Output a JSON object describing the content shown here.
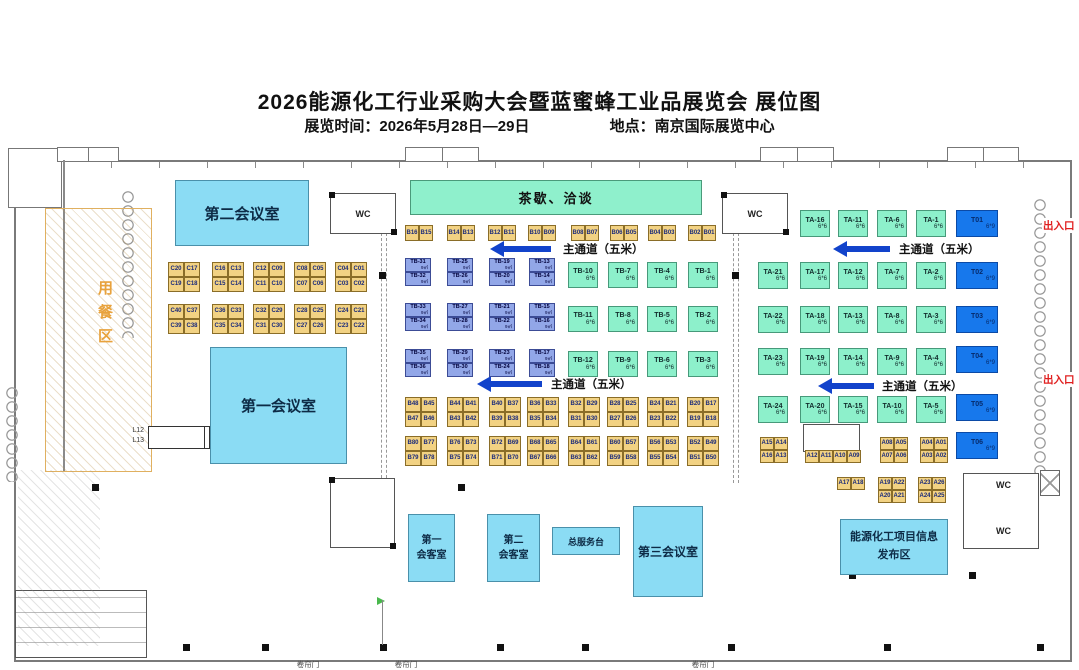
{
  "header": {
    "title": "2026能源化工行业采购大会暨蓝蜜蜂工业品展览会 展位图",
    "time": "展览时间：2026年5月28日—29日",
    "location": "地点：南京国际展览中心"
  },
  "labels": {
    "aisle": "主通道（五米）",
    "exit": "出入口",
    "dining": "用餐区",
    "shutter": "卷帘门",
    "wc": "WC"
  },
  "areas": {
    "tea": "茶歇、洽谈",
    "meeting1": "第一会议室",
    "meeting2": "第二会议室",
    "meeting3": "第三会议室",
    "reception1": {
      "line1": "第一",
      "line2": "会客室"
    },
    "reception2": {
      "line1": "第二",
      "line2": "会客室"
    },
    "service_desk": "总服务台",
    "info_zone": {
      "line1": "能源化工项目信息",
      "line2": "发布区"
    },
    "l_booths": {
      "top": "L12",
      "bottom": "L13"
    }
  },
  "booth_groups": [
    {
      "t": "y",
      "x": 168,
      "y": 262,
      "w": 16,
      "h": 15,
      "r": [
        [
          "C20",
          "C17"
        ],
        [
          "C19",
          "C18"
        ]
      ]
    },
    {
      "t": "y",
      "x": 212,
      "y": 262,
      "w": 16,
      "h": 15,
      "r": [
        [
          "C16",
          "C13"
        ],
        [
          "C15",
          "C14"
        ]
      ]
    },
    {
      "t": "y",
      "x": 253,
      "y": 262,
      "w": 16,
      "h": 15,
      "r": [
        [
          "C12",
          "C09"
        ],
        [
          "C11",
          "C10"
        ]
      ]
    },
    {
      "t": "y",
      "x": 294,
      "y": 262,
      "w": 16,
      "h": 15,
      "r": [
        [
          "C08",
          "C05"
        ],
        [
          "C07",
          "C06"
        ]
      ]
    },
    {
      "t": "y",
      "x": 335,
      "y": 262,
      "w": 16,
      "h": 15,
      "r": [
        [
          "C04",
          "C01"
        ],
        [
          "C03",
          "C02"
        ]
      ]
    },
    {
      "t": "y",
      "x": 168,
      "y": 304,
      "w": 16,
      "h": 15,
      "r": [
        [
          "C40",
          "C37"
        ],
        [
          "C39",
          "C38"
        ]
      ]
    },
    {
      "t": "y",
      "x": 212,
      "y": 304,
      "w": 16,
      "h": 15,
      "r": [
        [
          "C36",
          "C33"
        ],
        [
          "C35",
          "C34"
        ]
      ]
    },
    {
      "t": "y",
      "x": 253,
      "y": 304,
      "w": 16,
      "h": 15,
      "r": [
        [
          "C32",
          "C29"
        ],
        [
          "C31",
          "C30"
        ]
      ]
    },
    {
      "t": "y",
      "x": 294,
      "y": 304,
      "w": 16,
      "h": 15,
      "r": [
        [
          "C28",
          "C25"
        ],
        [
          "C27",
          "C26"
        ]
      ]
    },
    {
      "t": "y",
      "x": 335,
      "y": 304,
      "w": 16,
      "h": 15,
      "r": [
        [
          "C24",
          "C21"
        ],
        [
          "C23",
          "C22"
        ]
      ]
    },
    {
      "t": "y",
      "x": 405,
      "y": 225,
      "w": 14,
      "h": 16,
      "r": [
        [
          "B16",
          "B15"
        ]
      ]
    },
    {
      "t": "y",
      "x": 447,
      "y": 225,
      "w": 14,
      "h": 16,
      "r": [
        [
          "B14",
          "B13"
        ]
      ]
    },
    {
      "t": "y",
      "x": 488,
      "y": 225,
      "w": 14,
      "h": 16,
      "r": [
        [
          "B12",
          "B11"
        ]
      ]
    },
    {
      "t": "y",
      "x": 528,
      "y": 225,
      "w": 14,
      "h": 16,
      "r": [
        [
          "B10",
          "B09"
        ]
      ]
    },
    {
      "t": "y",
      "x": 571,
      "y": 225,
      "w": 14,
      "h": 16,
      "r": [
        [
          "B08",
          "B07"
        ]
      ]
    },
    {
      "t": "y",
      "x": 610,
      "y": 225,
      "w": 14,
      "h": 16,
      "r": [
        [
          "B06",
          "B05"
        ]
      ]
    },
    {
      "t": "y",
      "x": 648,
      "y": 225,
      "w": 14,
      "h": 16,
      "r": [
        [
          "B04",
          "B03"
        ]
      ]
    },
    {
      "t": "y",
      "x": 688,
      "y": 225,
      "w": 14,
      "h": 16,
      "r": [
        [
          "B02",
          "B01"
        ]
      ]
    },
    {
      "t": "b",
      "x": 405,
      "y": 258,
      "w": 26,
      "h": 14,
      "s": "9㎡",
      "r": [
        [
          "TB-31"
        ],
        [
          "TB-32"
        ]
      ]
    },
    {
      "t": "b",
      "x": 447,
      "y": 258,
      "w": 26,
      "h": 14,
      "s": "9㎡",
      "r": [
        [
          "TB-25"
        ],
        [
          "TB-26"
        ]
      ]
    },
    {
      "t": "b",
      "x": 489,
      "y": 258,
      "w": 26,
      "h": 14,
      "s": "9㎡",
      "r": [
        [
          "TB-19"
        ],
        [
          "TB-20"
        ]
      ]
    },
    {
      "t": "b",
      "x": 529,
      "y": 258,
      "w": 26,
      "h": 14,
      "s": "9㎡",
      "r": [
        [
          "TB-13"
        ],
        [
          "TB-14"
        ]
      ]
    },
    {
      "t": "b",
      "x": 405,
      "y": 303,
      "w": 26,
      "h": 14,
      "s": "9㎡",
      "r": [
        [
          "TB-33"
        ],
        [
          "TB-34"
        ]
      ]
    },
    {
      "t": "b",
      "x": 447,
      "y": 303,
      "w": 26,
      "h": 14,
      "s": "9㎡",
      "r": [
        [
          "TB-27"
        ],
        [
          "TB-28"
        ]
      ]
    },
    {
      "t": "b",
      "x": 489,
      "y": 303,
      "w": 26,
      "h": 14,
      "s": "9㎡",
      "r": [
        [
          "TB-21"
        ],
        [
          "TB-22"
        ]
      ]
    },
    {
      "t": "b",
      "x": 529,
      "y": 303,
      "w": 26,
      "h": 14,
      "s": "9㎡",
      "r": [
        [
          "TB-15"
        ],
        [
          "TB-16"
        ]
      ]
    },
    {
      "t": "b",
      "x": 405,
      "y": 349,
      "w": 26,
      "h": 14,
      "s": "9㎡",
      "r": [
        [
          "TB-35"
        ],
        [
          "TB-36"
        ]
      ]
    },
    {
      "t": "b",
      "x": 447,
      "y": 349,
      "w": 26,
      "h": 14,
      "s": "9㎡",
      "r": [
        [
          "TB-29"
        ],
        [
          "TB-30"
        ]
      ]
    },
    {
      "t": "b",
      "x": 489,
      "y": 349,
      "w": 26,
      "h": 14,
      "s": "9㎡",
      "r": [
        [
          "TB-23"
        ],
        [
          "TB-24"
        ]
      ]
    },
    {
      "t": "b",
      "x": 529,
      "y": 349,
      "w": 26,
      "h": 14,
      "s": "9㎡",
      "r": [
        [
          "TB-17"
        ],
        [
          "TB-18"
        ]
      ]
    },
    {
      "t": "g",
      "x": 568,
      "y": 262,
      "w": 30,
      "h": 26,
      "s": "6*6",
      "r": [
        [
          "TB-10"
        ]
      ]
    },
    {
      "t": "g",
      "x": 568,
      "y": 306,
      "w": 30,
      "h": 26,
      "s": "6*6",
      "r": [
        [
          "TB-11"
        ]
      ]
    },
    {
      "t": "g",
      "x": 568,
      "y": 351,
      "w": 30,
      "h": 26,
      "s": "6*6",
      "r": [
        [
          "TB-12"
        ]
      ]
    },
    {
      "t": "g",
      "x": 608,
      "y": 262,
      "w": 30,
      "h": 26,
      "s": "6*6",
      "r": [
        [
          "TB-7"
        ]
      ]
    },
    {
      "t": "g",
      "x": 608,
      "y": 306,
      "w": 30,
      "h": 26,
      "s": "6*6",
      "r": [
        [
          "TB-8"
        ]
      ]
    },
    {
      "t": "g",
      "x": 608,
      "y": 351,
      "w": 30,
      "h": 26,
      "s": "6*6",
      "r": [
        [
          "TB-9"
        ]
      ]
    },
    {
      "t": "g",
      "x": 647,
      "y": 262,
      "w": 30,
      "h": 26,
      "s": "6*6",
      "r": [
        [
          "TB-4"
        ]
      ]
    },
    {
      "t": "g",
      "x": 647,
      "y": 306,
      "w": 30,
      "h": 26,
      "s": "6*6",
      "r": [
        [
          "TB-5"
        ]
      ]
    },
    {
      "t": "g",
      "x": 647,
      "y": 351,
      "w": 30,
      "h": 26,
      "s": "6*6",
      "r": [
        [
          "TB-6"
        ]
      ]
    },
    {
      "t": "g",
      "x": 688,
      "y": 262,
      "w": 30,
      "h": 26,
      "s": "6*6",
      "r": [
        [
          "TB-1"
        ]
      ]
    },
    {
      "t": "g",
      "x": 688,
      "y": 306,
      "w": 30,
      "h": 26,
      "s": "6*6",
      "r": [
        [
          "TB-2"
        ]
      ]
    },
    {
      "t": "g",
      "x": 688,
      "y": 351,
      "w": 30,
      "h": 26,
      "s": "6*6",
      "r": [
        [
          "TB-3"
        ]
      ]
    },
    {
      "t": "g",
      "x": 800,
      "y": 210,
      "w": 30,
      "h": 27,
      "s": "6*6",
      "r": [
        [
          "TA-16"
        ]
      ]
    },
    {
      "t": "g",
      "x": 838,
      "y": 210,
      "w": 30,
      "h": 27,
      "s": "6*6",
      "r": [
        [
          "TA-11"
        ]
      ]
    },
    {
      "t": "g",
      "x": 877,
      "y": 210,
      "w": 30,
      "h": 27,
      "s": "6*6",
      "r": [
        [
          "TA-6"
        ]
      ]
    },
    {
      "t": "g",
      "x": 916,
      "y": 210,
      "w": 30,
      "h": 27,
      "s": "6*6",
      "r": [
        [
          "TA-1"
        ]
      ]
    },
    {
      "t": "g",
      "x": 758,
      "y": 262,
      "w": 30,
      "h": 27,
      "s": "6*6",
      "r": [
        [
          "TA-21"
        ]
      ]
    },
    {
      "t": "g",
      "x": 800,
      "y": 262,
      "w": 30,
      "h": 27,
      "s": "6*6",
      "r": [
        [
          "TA-17"
        ]
      ]
    },
    {
      "t": "g",
      "x": 838,
      "y": 262,
      "w": 30,
      "h": 27,
      "s": "6*6",
      "r": [
        [
          "TA-12"
        ]
      ]
    },
    {
      "t": "g",
      "x": 877,
      "y": 262,
      "w": 30,
      "h": 27,
      "s": "6*6",
      "r": [
        [
          "TA-7"
        ]
      ]
    },
    {
      "t": "g",
      "x": 916,
      "y": 262,
      "w": 30,
      "h": 27,
      "s": "6*6",
      "r": [
        [
          "TA-2"
        ]
      ]
    },
    {
      "t": "g",
      "x": 758,
      "y": 306,
      "w": 30,
      "h": 27,
      "s": "6*6",
      "r": [
        [
          "TA-22"
        ]
      ]
    },
    {
      "t": "g",
      "x": 800,
      "y": 306,
      "w": 30,
      "h": 27,
      "s": "6*6",
      "r": [
        [
          "TA-18"
        ]
      ]
    },
    {
      "t": "g",
      "x": 838,
      "y": 306,
      "w": 30,
      "h": 27,
      "s": "6*6",
      "r": [
        [
          "TA-13"
        ]
      ]
    },
    {
      "t": "g",
      "x": 877,
      "y": 306,
      "w": 30,
      "h": 27,
      "s": "6*6",
      "r": [
        [
          "TA-8"
        ]
      ]
    },
    {
      "t": "g",
      "x": 916,
      "y": 306,
      "w": 30,
      "h": 27,
      "s": "6*6",
      "r": [
        [
          "TA-3"
        ]
      ]
    },
    {
      "t": "g",
      "x": 758,
      "y": 348,
      "w": 30,
      "h": 27,
      "s": "6*6",
      "r": [
        [
          "TA-23"
        ]
      ]
    },
    {
      "t": "g",
      "x": 800,
      "y": 348,
      "w": 30,
      "h": 27,
      "s": "6*6",
      "r": [
        [
          "TA-19"
        ]
      ]
    },
    {
      "t": "g",
      "x": 838,
      "y": 348,
      "w": 30,
      "h": 27,
      "s": "6*6",
      "r": [
        [
          "TA-14"
        ]
      ]
    },
    {
      "t": "g",
      "x": 877,
      "y": 348,
      "w": 30,
      "h": 27,
      "s": "6*6",
      "r": [
        [
          "TA-9"
        ]
      ]
    },
    {
      "t": "g",
      "x": 916,
      "y": 348,
      "w": 30,
      "h": 27,
      "s": "6*6",
      "r": [
        [
          "TA-4"
        ]
      ]
    },
    {
      "t": "g",
      "x": 758,
      "y": 396,
      "w": 30,
      "h": 27,
      "s": "6*6",
      "r": [
        [
          "TA-24"
        ]
      ]
    },
    {
      "t": "g",
      "x": 800,
      "y": 396,
      "w": 30,
      "h": 27,
      "s": "6*6",
      "r": [
        [
          "TA-20"
        ]
      ]
    },
    {
      "t": "g",
      "x": 838,
      "y": 396,
      "w": 30,
      "h": 27,
      "s": "6*6",
      "r": [
        [
          "TA-15"
        ]
      ]
    },
    {
      "t": "g",
      "x": 877,
      "y": 396,
      "w": 30,
      "h": 27,
      "s": "6*6",
      "r": [
        [
          "TA-10"
        ]
      ]
    },
    {
      "t": "g",
      "x": 916,
      "y": 396,
      "w": 30,
      "h": 27,
      "s": "6*6",
      "r": [
        [
          "TA-5"
        ]
      ]
    },
    {
      "t": "d",
      "x": 956,
      "y": 210,
      "w": 42,
      "h": 27,
      "s": "6*9",
      "r": [
        [
          "T01"
        ]
      ]
    },
    {
      "t": "d",
      "x": 956,
      "y": 262,
      "w": 42,
      "h": 27,
      "s": "6*9",
      "r": [
        [
          "T02"
        ]
      ]
    },
    {
      "t": "d",
      "x": 956,
      "y": 306,
      "w": 42,
      "h": 27,
      "s": "6*9",
      "r": [
        [
          "T03"
        ]
      ]
    },
    {
      "t": "d",
      "x": 956,
      "y": 346,
      "w": 42,
      "h": 27,
      "s": "6*9",
      "r": [
        [
          "T04"
        ]
      ]
    },
    {
      "t": "d",
      "x": 956,
      "y": 394,
      "w": 42,
      "h": 27,
      "s": "6*9",
      "r": [
        [
          "T05"
        ]
      ]
    },
    {
      "t": "d",
      "x": 956,
      "y": 432,
      "w": 42,
      "h": 27,
      "s": "6*9",
      "r": [
        [
          "T06"
        ]
      ]
    },
    {
      "t": "y",
      "x": 405,
      "y": 397,
      "w": 16,
      "h": 15,
      "r": [
        [
          "B48",
          "B45"
        ],
        [
          "B47",
          "B46"
        ]
      ]
    },
    {
      "t": "y",
      "x": 447,
      "y": 397,
      "w": 16,
      "h": 15,
      "r": [
        [
          "B44",
          "B41"
        ],
        [
          "B43",
          "B42"
        ]
      ]
    },
    {
      "t": "y",
      "x": 489,
      "y": 397,
      "w": 16,
      "h": 15,
      "r": [
        [
          "B40",
          "B37"
        ],
        [
          "B39",
          "B38"
        ]
      ]
    },
    {
      "t": "y",
      "x": 527,
      "y": 397,
      "w": 16,
      "h": 15,
      "r": [
        [
          "B36",
          "B33"
        ],
        [
          "B35",
          "B34"
        ]
      ]
    },
    {
      "t": "y",
      "x": 568,
      "y": 397,
      "w": 16,
      "h": 15,
      "r": [
        [
          "B32",
          "B29"
        ],
        [
          "B31",
          "B30"
        ]
      ]
    },
    {
      "t": "y",
      "x": 607,
      "y": 397,
      "w": 16,
      "h": 15,
      "r": [
        [
          "B28",
          "B25"
        ],
        [
          "B27",
          "B26"
        ]
      ]
    },
    {
      "t": "y",
      "x": 647,
      "y": 397,
      "w": 16,
      "h": 15,
      "r": [
        [
          "B24",
          "B21"
        ],
        [
          "B23",
          "B22"
        ]
      ]
    },
    {
      "t": "y",
      "x": 687,
      "y": 397,
      "w": 16,
      "h": 15,
      "r": [
        [
          "B20",
          "B17"
        ],
        [
          "B19",
          "B18"
        ]
      ]
    },
    {
      "t": "y",
      "x": 405,
      "y": 436,
      "w": 16,
      "h": 15,
      "r": [
        [
          "B80",
          "B77"
        ],
        [
          "B79",
          "B78"
        ]
      ]
    },
    {
      "t": "y",
      "x": 447,
      "y": 436,
      "w": 16,
      "h": 15,
      "r": [
        [
          "B76",
          "B73"
        ],
        [
          "B75",
          "B74"
        ]
      ]
    },
    {
      "t": "y",
      "x": 489,
      "y": 436,
      "w": 16,
      "h": 15,
      "r": [
        [
          "B72",
          "B69"
        ],
        [
          "B71",
          "B70"
        ]
      ]
    },
    {
      "t": "y",
      "x": 527,
      "y": 436,
      "w": 16,
      "h": 15,
      "r": [
        [
          "B68",
          "B65"
        ],
        [
          "B67",
          "B66"
        ]
      ]
    },
    {
      "t": "y",
      "x": 568,
      "y": 436,
      "w": 16,
      "h": 15,
      "r": [
        [
          "B64",
          "B61"
        ],
        [
          "B63",
          "B62"
        ]
      ]
    },
    {
      "t": "y",
      "x": 607,
      "y": 436,
      "w": 16,
      "h": 15,
      "r": [
        [
          "B60",
          "B57"
        ],
        [
          "B59",
          "B58"
        ]
      ]
    },
    {
      "t": "y",
      "x": 647,
      "y": 436,
      "w": 16,
      "h": 15,
      "r": [
        [
          "B56",
          "B53"
        ],
        [
          "B55",
          "B54"
        ]
      ]
    },
    {
      "t": "y",
      "x": 687,
      "y": 436,
      "w": 16,
      "h": 15,
      "r": [
        [
          "B52",
          "B49"
        ],
        [
          "B51",
          "B50"
        ]
      ]
    },
    {
      "t": "y",
      "x": 760,
      "y": 437,
      "w": 14,
      "h": 13,
      "r": [
        [
          "A15",
          "A14"
        ],
        [
          "A16",
          "A13"
        ]
      ]
    },
    {
      "t": "y",
      "x": 805,
      "y": 450,
      "w": 14,
      "h": 13,
      "r": [
        [
          "A12",
          "A11",
          "A10",
          "A09"
        ]
      ]
    },
    {
      "t": "y",
      "x": 880,
      "y": 437,
      "w": 14,
      "h": 13,
      "r": [
        [
          "A08",
          "A05"
        ],
        [
          "A07",
          "A06"
        ]
      ]
    },
    {
      "t": "y",
      "x": 920,
      "y": 437,
      "w": 14,
      "h": 13,
      "r": [
        [
          "A04",
          "A01"
        ],
        [
          "A03",
          "A02"
        ]
      ]
    },
    {
      "t": "y",
      "x": 837,
      "y": 477,
      "w": 14,
      "h": 13,
      "r": [
        [
          "A17",
          "A18"
        ]
      ]
    },
    {
      "t": "y",
      "x": 878,
      "y": 477,
      "w": 14,
      "h": 13,
      "r": [
        [
          "A19",
          "A22"
        ],
        [
          "A20",
          "A21"
        ]
      ]
    },
    {
      "t": "y",
      "x": 918,
      "y": 477,
      "w": 14,
      "h": 13,
      "r": [
        [
          "A23",
          "A26"
        ],
        [
          "A24",
          "A25"
        ]
      ]
    }
  ]
}
